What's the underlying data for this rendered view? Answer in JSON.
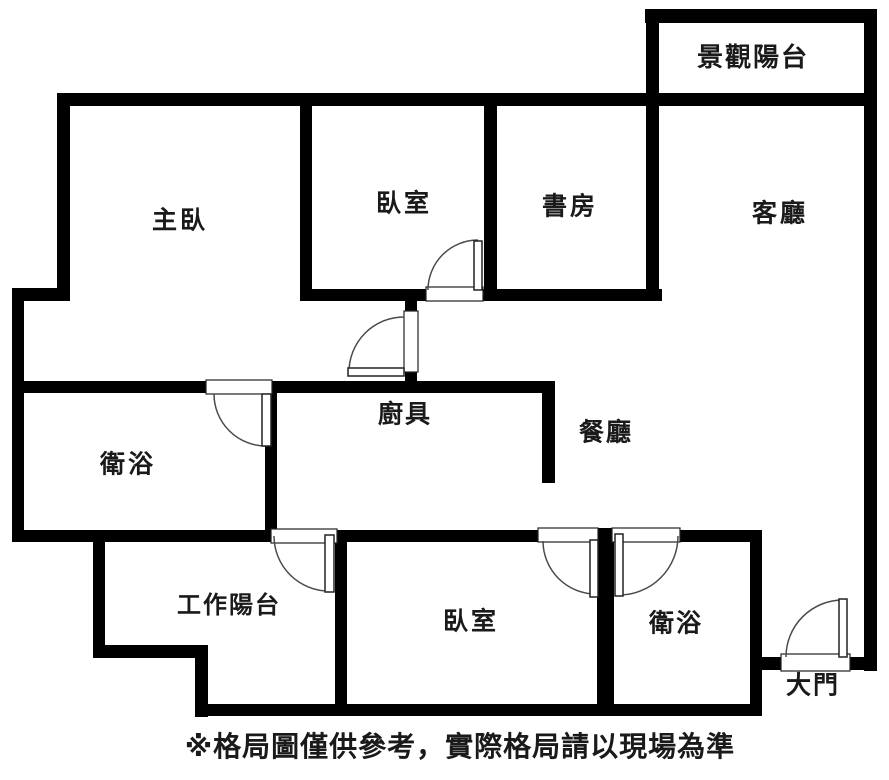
{
  "plan": {
    "rooms": {
      "view_balcony": {
        "label": "景觀陽台"
      },
      "master_bedroom": {
        "label": "主臥"
      },
      "bedroom_top": {
        "label": "臥室"
      },
      "study": {
        "label": "書房"
      },
      "living_room": {
        "label": "客廳"
      },
      "ensuite_bath": {
        "label": "衛浴"
      },
      "kitchen": {
        "label": "廚具"
      },
      "dining": {
        "label": "餐廳"
      },
      "work_balcony": {
        "label": "工作陽台"
      },
      "bedroom_bottom": {
        "label": "臥室"
      },
      "bath_bottom": {
        "label": "衛浴"
      },
      "main_door": {
        "label": "大門"
      }
    },
    "disclaimer": "※格局圖僅供參考，實際格局請以現場為準",
    "colors": {
      "wall": "#000000",
      "background": "#ffffff",
      "text": "#1a1a1a",
      "door_line": "#4a4a4a"
    }
  }
}
